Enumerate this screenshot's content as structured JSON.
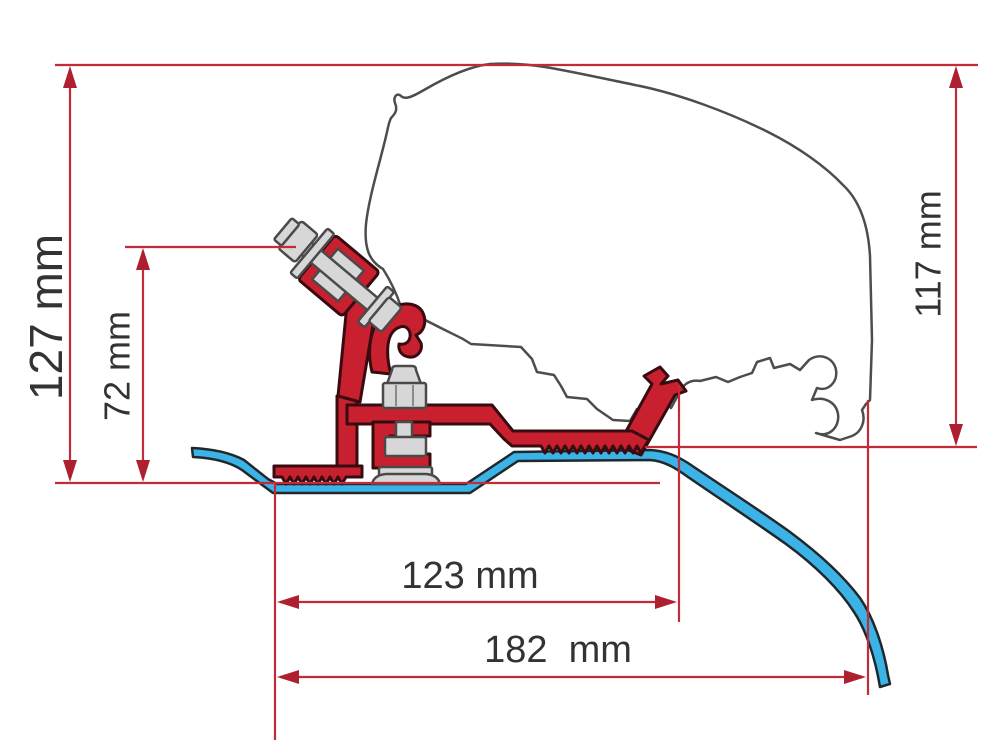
{
  "diagram": {
    "kind": "technical-dimension-drawing",
    "parts": {
      "adapter_bracket": "red-adapter-bracket",
      "roof_profile": "blue-vehicle-roof-profile",
      "vehicle_outline": "grey-vehicle-body-outline",
      "fixing_hardware": "grey-bolts-and-nuts"
    }
  },
  "dimensions": {
    "overall_height": {
      "label": "127 mm",
      "value": 127,
      "unit": "mm",
      "orientation": "vertical"
    },
    "adapter_height": {
      "label": "72 mm",
      "value": 72,
      "unit": "mm",
      "orientation": "vertical"
    },
    "vehicle_side_height": {
      "label": "117 mm",
      "value": 117,
      "unit": "mm",
      "orientation": "vertical"
    },
    "bracket_span": {
      "label": "123 mm",
      "value": 123,
      "unit": "mm",
      "orientation": "horizontal"
    },
    "overall_span": {
      "label": "182  mm",
      "value": 182,
      "unit": "mm",
      "orientation": "horizontal"
    }
  },
  "colors": {
    "background": "#ffffff",
    "dimension_line": "#c22b3a",
    "arrowhead": "#ae1f30",
    "bracket_red": "#c8202f",
    "bracket_outline": "#380b10",
    "roof_blue": "#3bb3e6",
    "roof_outline": "#20282c",
    "vehicle_outline": "#4d4d4d",
    "hardware_gray": "#d7d7d7",
    "hardware_outline": "#4a4a4a",
    "label_text": "#333333"
  }
}
